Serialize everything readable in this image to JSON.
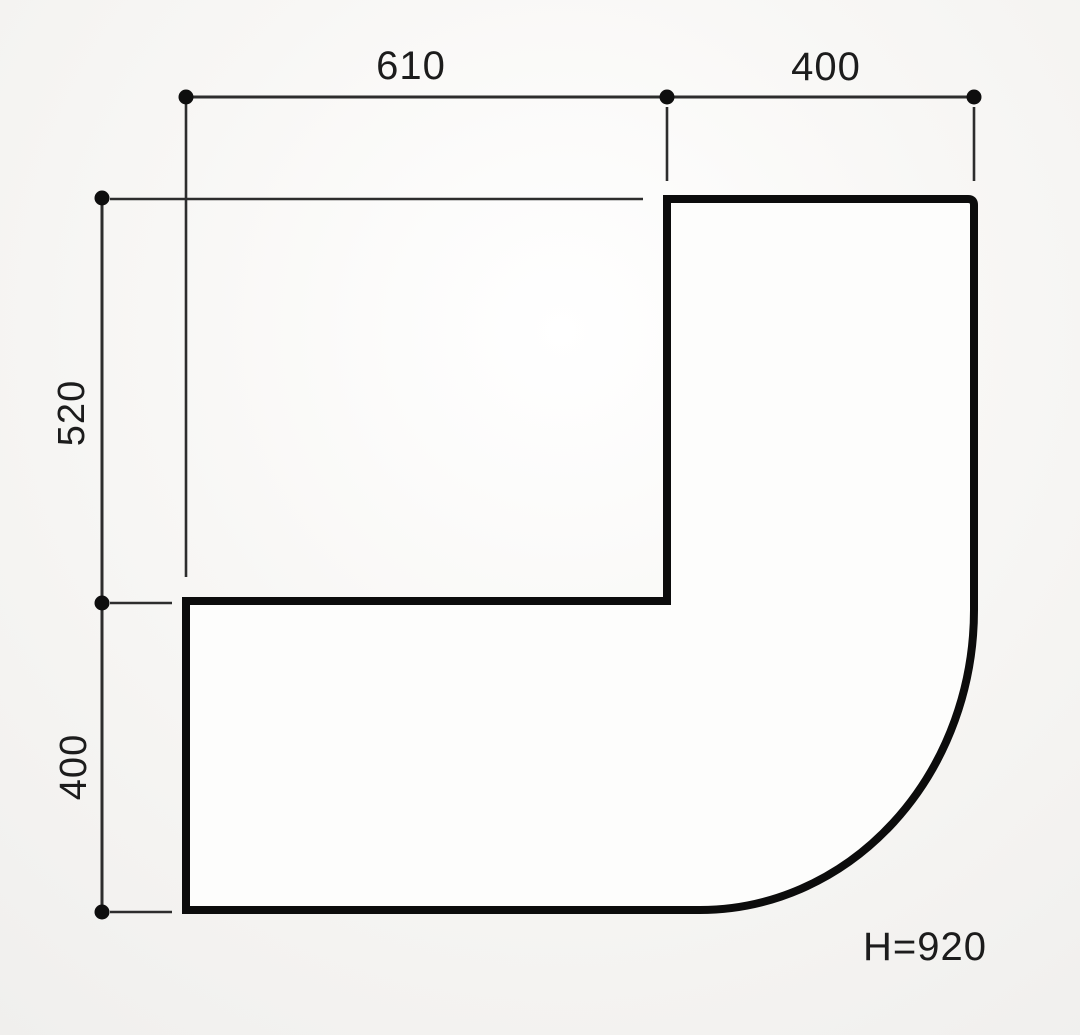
{
  "dimensions": {
    "top": [
      {
        "value": 610,
        "label": "610"
      },
      {
        "value": 400,
        "label": "400"
      }
    ],
    "left": [
      {
        "value": 520,
        "label": "520"
      },
      {
        "value": 400,
        "label": "400"
      }
    ],
    "height_annotation": "H=920"
  },
  "colors": {
    "outline": "#0c0c0c",
    "dimension": "#2d2d2d",
    "text": "#1c1c1c",
    "paper": "#f0efed",
    "paper_highlight": "#ffffff"
  }
}
